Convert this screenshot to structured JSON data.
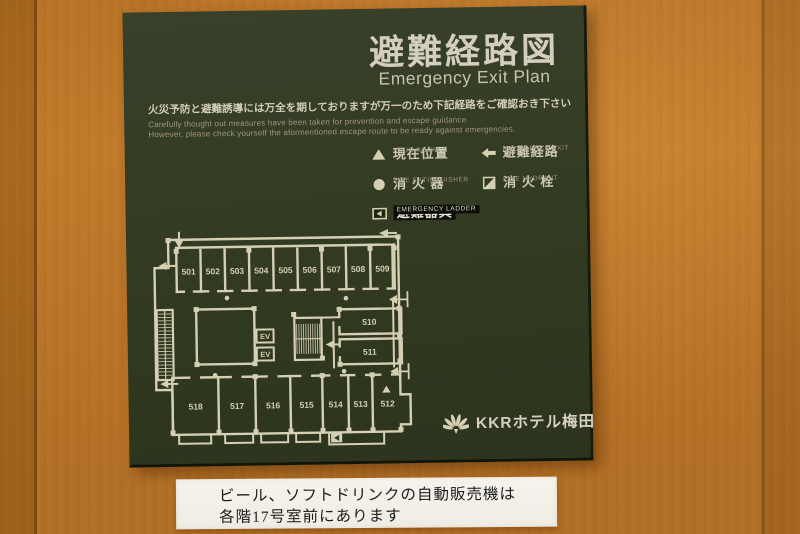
{
  "sign": {
    "title_ja": "避難経路図",
    "title_en": "Emergency Exit Plan",
    "notice_ja": "火災予防と避難誘導には万全を期しておりますが万一のため下記経路をご確認おき下さい",
    "notice_en_line1": "Carefully thought out measures have been taken for prevention and escape guidance.",
    "notice_en_line2": "However, please check yourself the aformentioned escape route to be ready against emergencies.",
    "legend": {
      "your_room": {
        "label": "現在位置",
        "caption": "YOUR ROOM"
      },
      "fire_extinguisher": {
        "label": "消 火 器",
        "caption": "FIRE EXTINGUISHER"
      },
      "emergency_ladder": {
        "label": "避難器具",
        "caption": "EMERGENCY LADDER"
      },
      "emergency_exit": {
        "label": "避難経路",
        "caption": "EMERGENCY EXIT"
      },
      "fire_hydrant": {
        "label": "消 火 栓",
        "caption": "FIRE HYDRANT"
      }
    },
    "floor_plan": {
      "top_rooms": [
        "501",
        "502",
        "503",
        "504",
        "505",
        "506",
        "507",
        "508",
        "509"
      ],
      "right_rooms": [
        "510",
        "511"
      ],
      "bottom_rooms": [
        "518",
        "517",
        "516",
        "515",
        "514",
        "513",
        "512"
      ],
      "elevator_label": "EV",
      "current_position_room": "512"
    },
    "brand_name": "KKRホテル梅田"
  },
  "paper_note": {
    "line1": "ビール、ソフトドリンクの自動販売機は",
    "line2": "各階17号室前にあります"
  },
  "colors": {
    "sign_green": "#333b22",
    "sign_text": "#d2cbb8",
    "plan_line": "#d5cfb3",
    "wood": "#c07a2b",
    "paper": "#f4f1e9"
  }
}
